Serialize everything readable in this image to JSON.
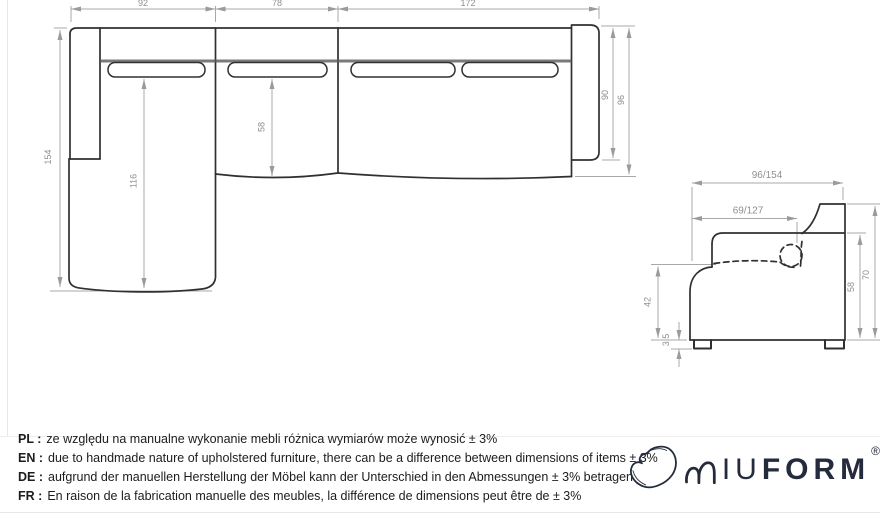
{
  "colors": {
    "outline": "#303030",
    "crease": "#5a5a5a",
    "dimension_line": "#a0a0a0",
    "dimension_text": "#8f8f8f",
    "logo": "#242b3c",
    "body_text": "#1c1c1c"
  },
  "top_view": {
    "dim_section_widths": [
      "92",
      "78",
      "172"
    ],
    "dim_chaise_depth": "154",
    "dim_chaise_length": "116",
    "dim_seat_depth": "58",
    "dim_arm_depth": "90",
    "dim_total_depth": "96"
  },
  "side_view": {
    "dim_total_depth": "96/154",
    "dim_inner_depth": "69/127",
    "dim_seat_height": "42",
    "dim_foot_height": "3.5",
    "dim_back_height": "58",
    "dim_total_height": "70"
  },
  "disclaimer": {
    "lines": [
      {
        "label": "PL :",
        "text": "ze względu na manualne wykonanie mebli różnica wymiarów może wynosić ± 3%"
      },
      {
        "label": "EN :",
        "text": "due to handmade nature of upholstered furniture, there can be a difference between dimensions of items ± 3%"
      },
      {
        "label": "DE :",
        "text": "aufgrund der manuellen Herstellung der Möbel kann der Unterschied in den Abmessungen ± 3% betragen"
      },
      {
        "label": "FR :",
        "text": "En raison de la fabrication manuelle des meubles, la différence de dimensions peut être de ± 3%"
      }
    ]
  },
  "logo": {
    "brand": "MIUFORM",
    "text_iu": "IU",
    "text_form": "FORM",
    "registered": "®"
  }
}
